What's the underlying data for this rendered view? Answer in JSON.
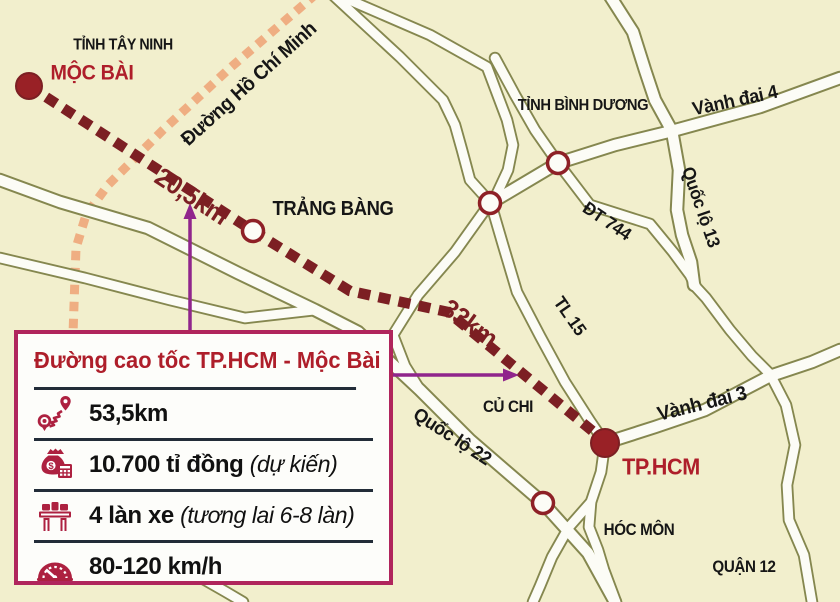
{
  "map": {
    "labels": {
      "tinh_tay_ninh": "TỈNH TÂY NINH",
      "moc_bai": "MỘC BÀI",
      "duong_ho_chi_minh": "Đường Hồ Chí Minh",
      "trang_bang": "TRẢNG BÀNG",
      "tinh_binh_duong": "TỈNH BÌNH DƯƠNG",
      "vanh_dai_4": "Vành đai 4",
      "quoc_lo_13": "Quốc lộ 13",
      "dt_744": "ĐT 744",
      "tl_15": "TL 15",
      "vanh_dai_3": "Vành đai 3",
      "quoc_lo_22": "Quốc lộ 22",
      "cu_chi": "CỦ CHI",
      "hoc_mon": "HÓC MÔN",
      "quan_12": "QUẬN 12",
      "tp_hcm": "TP.HCM",
      "distance_moc_bai_trang_bang": "20,5km",
      "distance_trang_bang_tphcm": "33km"
    }
  },
  "infobox": {
    "title": "Đường cao tốc TP.HCM - Mộc Bài",
    "rows": [
      {
        "icon": "route-length-icon",
        "value": "53,5km",
        "note": ""
      },
      {
        "icon": "investment-icon",
        "value": "10.700 tỉ đồng",
        "note": "(dự kiến)"
      },
      {
        "icon": "lanes-icon",
        "value": "4 làn xe",
        "note": "(tương lai 6-8 làn)"
      },
      {
        "icon": "speed-icon",
        "value": "80-120 km/h",
        "note": ""
      }
    ]
  },
  "colors": {
    "background": "#f2efcd",
    "road_casing": "#85874f",
    "road_fill": "#fcfcf6",
    "expressway_route": "#7c1f23",
    "ho_chi_minh_road": "#efae82",
    "arrow": "#90258c",
    "box_border": "#b0255c",
    "red_label": "#ae1e2a",
    "dark_label": "#161616",
    "separator": "#222c38"
  }
}
